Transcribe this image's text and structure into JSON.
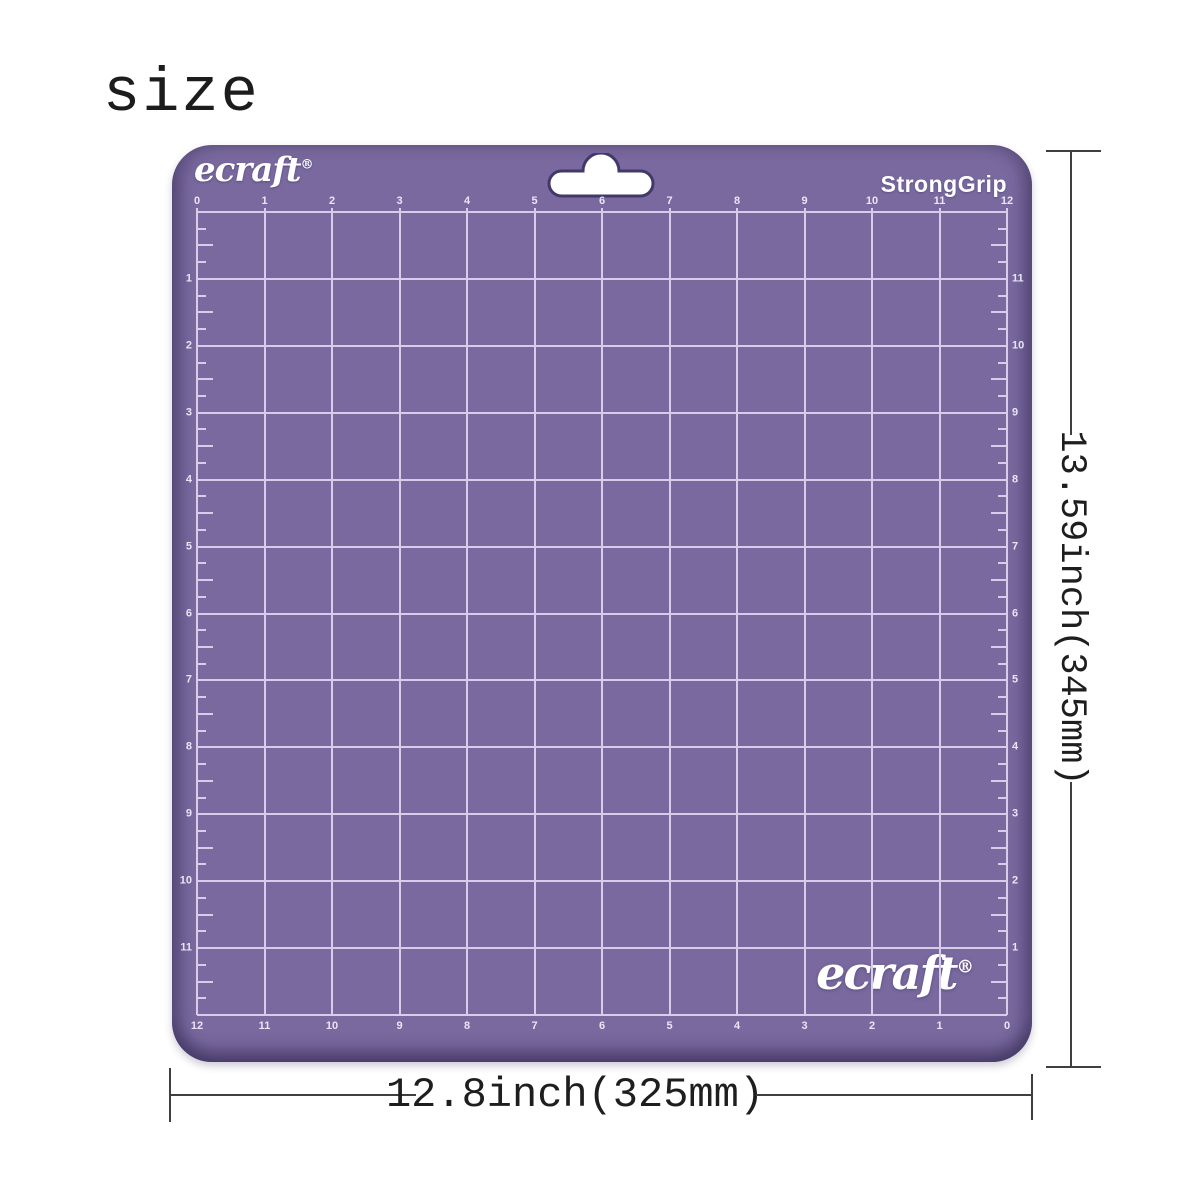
{
  "title": "size",
  "mat": {
    "brand_logo_top": "ecraft",
    "brand_logo_bottom": "ecraft",
    "registered_mark": "®",
    "grip_label": "StrongGrip",
    "colors": {
      "mat_purple": "#79699f",
      "grid_line": "#d6cdea",
      "ruler_numbers": "#e9e4f6",
      "slot_outline": "#43386a",
      "dimension_line": "#3f3f3f"
    },
    "rulers": {
      "top": [
        "0",
        "1",
        "2",
        "3",
        "4",
        "5",
        "6",
        "7",
        "8",
        "9",
        "10",
        "11",
        "12"
      ],
      "left": [
        "1",
        "2",
        "3",
        "4",
        "5",
        "6",
        "7",
        "8",
        "9",
        "10",
        "11"
      ],
      "right": [
        "11",
        "10",
        "9",
        "8",
        "7",
        "6",
        "5",
        "4",
        "3",
        "2",
        "1"
      ],
      "bottom": [
        "12",
        "11",
        "10",
        "9",
        "8",
        "7",
        "6",
        "5",
        "4",
        "3",
        "2",
        "1",
        "0"
      ]
    }
  },
  "dimensions": {
    "width_label": "12.8inch(325mm)",
    "height_label": "13.59inch(345mm)"
  }
}
